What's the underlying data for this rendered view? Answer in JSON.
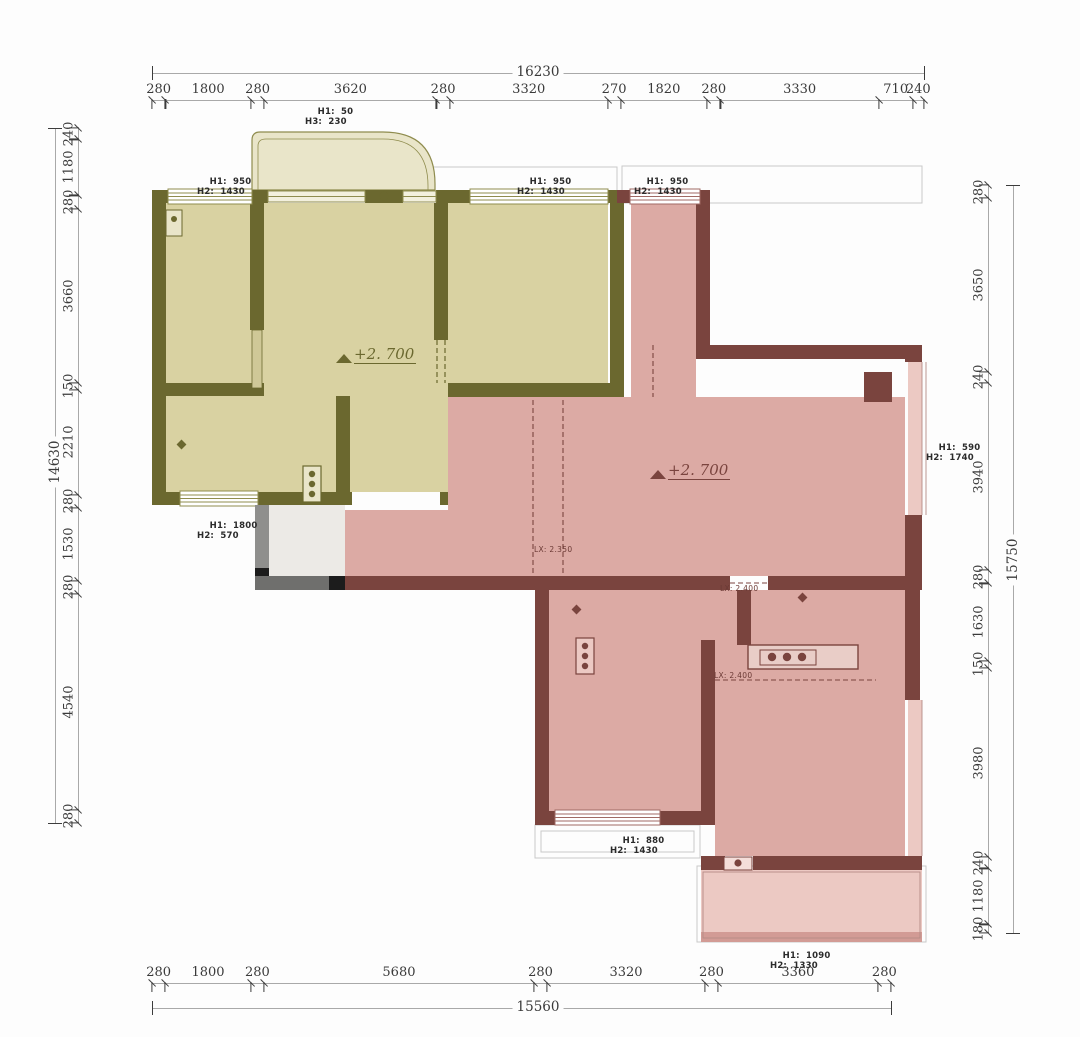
{
  "drawing_type": "floor-plan",
  "colors": {
    "olive_wall": "#6b682f",
    "olive_fill": "#d9d2a2",
    "olive_light": "#e9e5c9",
    "pink_wall": "#7a443e",
    "pink_fill": "#dcaaa4",
    "pink_light": "#ecc9c3",
    "entry_grey": "#eceae6",
    "dim_line": "#a9a9a9",
    "dim_text": "#3a3a3a"
  },
  "dimensions": {
    "top": {
      "total": "16230",
      "segments": [
        280,
        1800,
        280,
        3620,
        280,
        3320,
        270,
        1820,
        280,
        3330,
        710,
        240
      ]
    },
    "bottom": {
      "total": "15560",
      "segments": [
        280,
        1800,
        280,
        5680,
        280,
        3320,
        280,
        3360,
        280
      ]
    },
    "left": {
      "total": "14630",
      "segments": [
        240,
        1180,
        280,
        3660,
        150,
        2210,
        280,
        1530,
        280,
        4540,
        280
      ]
    },
    "right": {
      "total": "15750",
      "segments": [
        280,
        3650,
        240,
        3940,
        280,
        1630,
        150,
        3980,
        240,
        1180,
        180
      ]
    }
  },
  "opening_labels": [
    {
      "l1": "H1:  50",
      "l2": "H3:  230"
    },
    {
      "l1": "H1:  950",
      "l2": "H2:  1430"
    },
    {
      "l1": "H1:  950",
      "l2": "H2:  1430"
    },
    {
      "l1": "H1:  950",
      "l2": "H2:  1430"
    },
    {
      "l1": "H1:  1800",
      "l2": "H2:  570"
    },
    {
      "l1": "H1:  590",
      "l2": "H2:  1740"
    },
    {
      "l1": "H1:  880",
      "l2": "H2:  1430"
    },
    {
      "l1": "H1:  1090",
      "l2": "H2:  1330"
    }
  ],
  "elevations": [
    {
      "text": "+2. 700"
    },
    {
      "text": "+2. 700"
    }
  ],
  "beam_labels": [
    {
      "text": "LX: 2.350"
    },
    {
      "text": "LX: 2.400"
    },
    {
      "text": "LX: 2.400"
    }
  ]
}
